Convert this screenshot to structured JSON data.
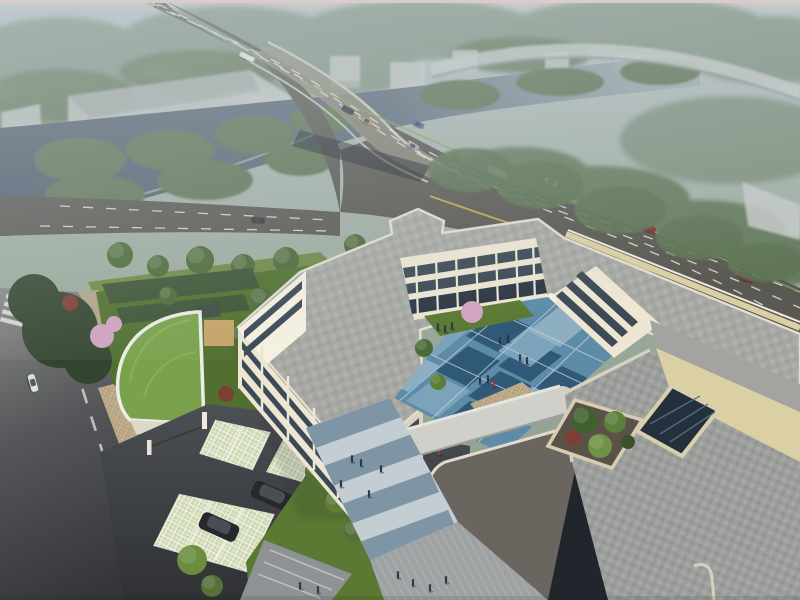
{
  "scene": {
    "type": "aerial architectural rendering",
    "description": "Hazy bird's-eye visualization of a three-storey cream courtyard building beside a river crossed by a wide vehicular bridge, with a blue checker plaza courtyard, green-roof gate pavilion, grass-paver parking and a large paved podium roof with skylight well and tree planter",
    "time_of_day": "hazy daylight"
  },
  "palette": {
    "haze_top": "#d8cdc8",
    "haze_sky": "#b4bfc2",
    "far_tree": "#7e907e",
    "mid_tree": "#5f7555",
    "tree_dark": "#34452f",
    "tree_green": "#4c6a38",
    "tree_bright": "#6c8c3e",
    "tree_yellow": "#93a14c",
    "blossom": "#d2a3c0",
    "red_shrub": "#7d3f34",
    "river": "#4f5b6b",
    "warehouse": "#c6cac8",
    "ramp": "#c6cbc8",
    "road": "#5a5852",
    "bridge_deck": "#948f80",
    "lane_marking": "#e8e7e2",
    "median_green": "#8fa35a",
    "lane_yellow": "#c5b24e",
    "street": "#55575a",
    "sidewalk": "#b3a489",
    "cobble": "#bba887",
    "driveway": "#43464a",
    "wall_cream": "#ece6d2",
    "wall_lit": "#f6f1e1",
    "wall_shade": "#d9d2bc",
    "window_dark": "#3c4a56",
    "roof_gray": "#a7a8a3",
    "roof_parapet": "#e4dfd2",
    "roof_dark": "#6b6560",
    "podium_paving": "#9c9e9c",
    "beige_parapet": "#dbd0a4",
    "skylight_glass": "#24303c",
    "courtyard_light": "#7ba4bb",
    "courtyard_mid": "#5d8ca9",
    "courtyard_dark": "#2f5977",
    "courtyard_pale": "#93b2c3",
    "lawn": "#5a7a33",
    "green_roof": "#7aa24d",
    "grass_paver": "#cbd6ad",
    "plaza_band_blue": "#7e95a6",
    "plaza_band_light": "#c3cdd2",
    "plaza_gray": "#9ea2a3",
    "steps": "#8e9294",
    "sand": "#c7a468",
    "solar_panel": "#3f4a43",
    "suv_black": "#26282b",
    "van_white": "#dfe2e3",
    "bus_white": "#d9dbd8",
    "car_red": "#8f2e28",
    "car_blue": "#4e739c",
    "car_tan": "#ac9866",
    "car_dark": "#33363a",
    "people_dark": "#2c3546",
    "people_red": "#9c3a30",
    "shadow": "#20262c"
  },
  "site": {
    "building_stories": 3,
    "wings": "U-shaped cream building with grey flat roofs",
    "courtyard_surface": "blue checkerboard plaza with lawn strip and blossom tree",
    "green_roof_pavilions": 1,
    "gate": "barrier gate with white pillars",
    "parking": "grass-paver stalls",
    "podium_roof": "grey paver roof terrace with square skylight well and tree planter"
  },
  "traffic": {
    "bridge_road_vehicles": 10,
    "buses": 2,
    "local_street_vehicles": 2,
    "parked_suvs": 2
  },
  "people": {
    "courtyard": 16,
    "south_plaza": 5,
    "bottom_walk": 6
  }
}
